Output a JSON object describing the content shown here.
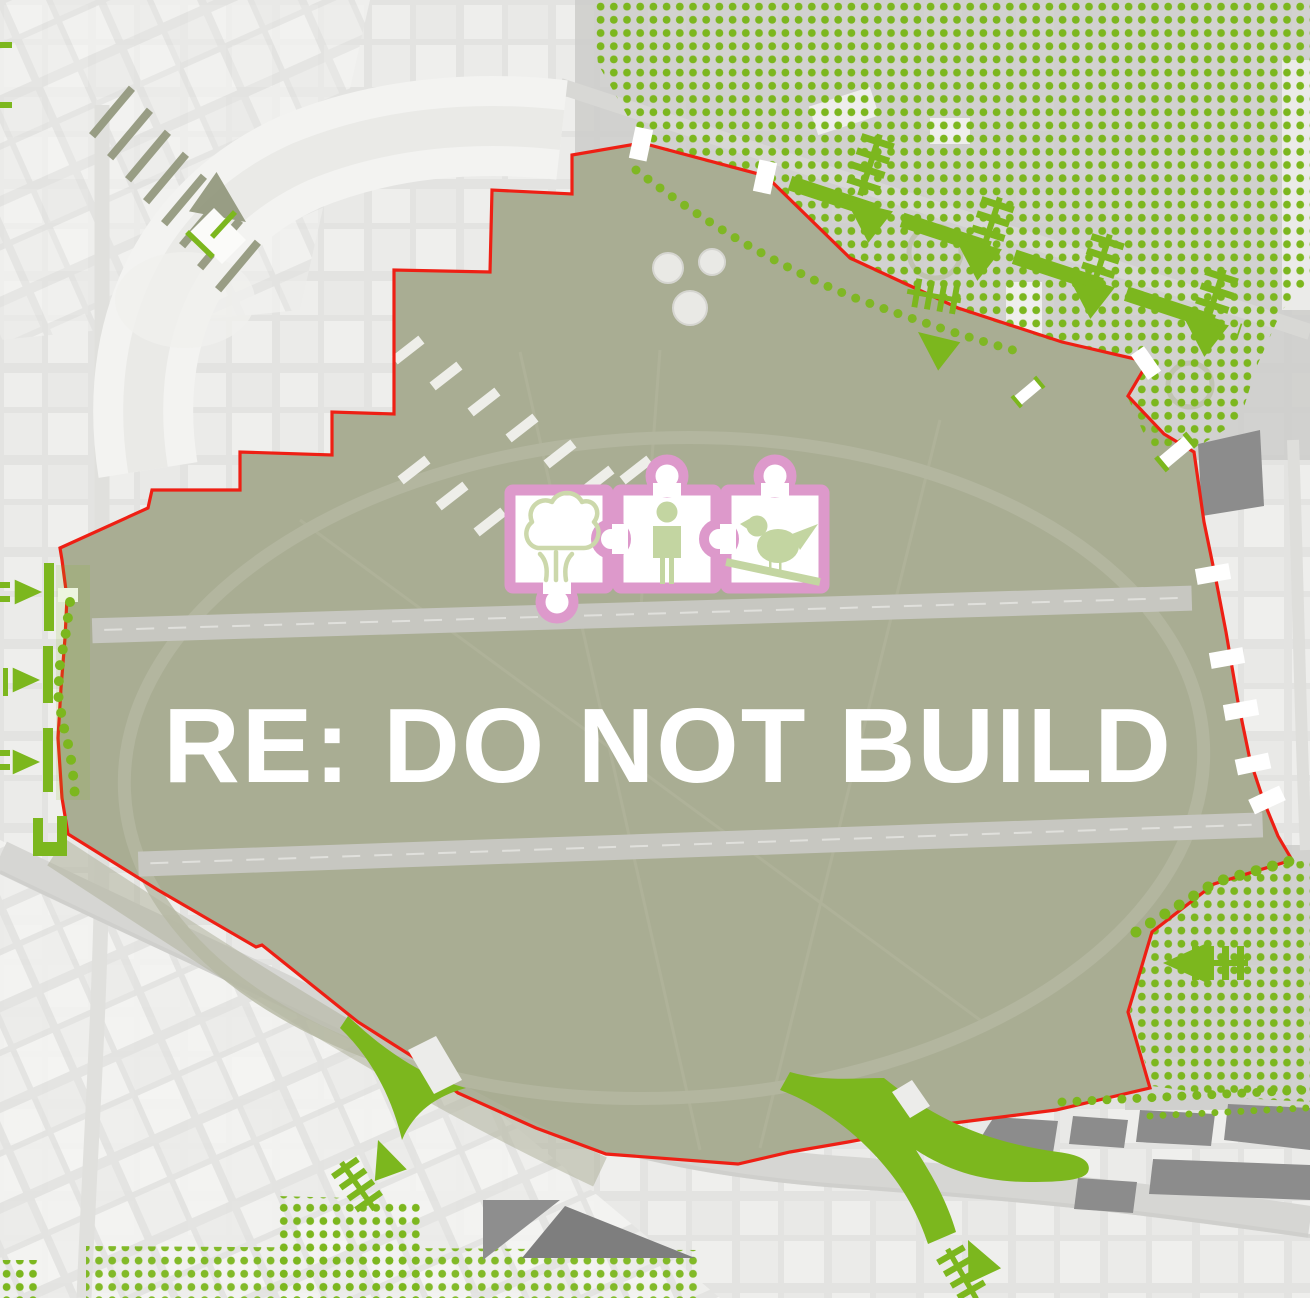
{
  "poster": {
    "title": "RE: DO NOT BUILD"
  },
  "colors": {
    "accent_green": "#7cb71e",
    "boundary_red": "#ee1f14",
    "puzzle_pink": "#dd99cb",
    "icon_green": "#c3d5a1",
    "icon_green_outline": "#ccd8ab",
    "field_olive": "#a9ad93",
    "building_gray": "#8c8c8c",
    "title_white": "#ffffff"
  },
  "icons": {
    "puzzle_pieces": [
      {
        "name": "tree-icon"
      },
      {
        "name": "person-icon"
      },
      {
        "name": "bird-icon"
      }
    ],
    "flow_marker": "green-arrow-icon",
    "crossing_marker": "ladder-icon",
    "vegetation_marker": "green-dot-grid"
  }
}
